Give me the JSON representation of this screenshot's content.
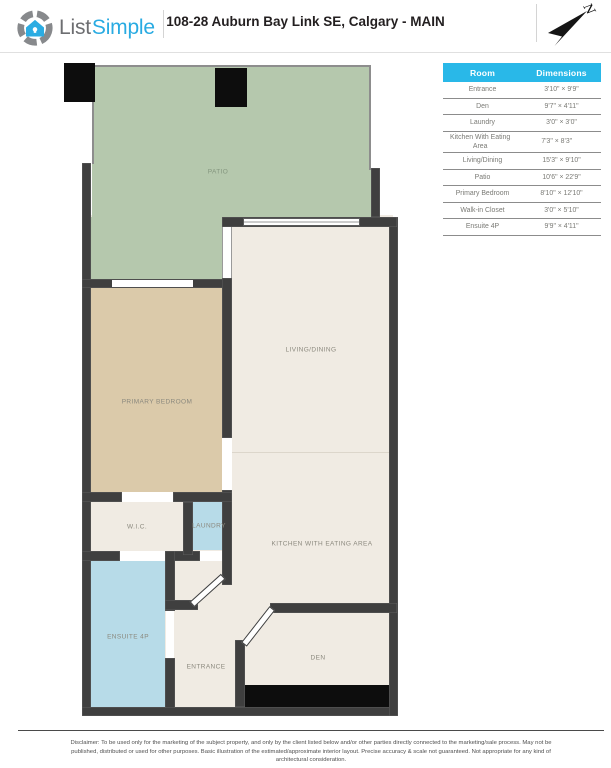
{
  "header": {
    "logo": {
      "list": "List",
      "simple": "Simple"
    },
    "title": "108-28 Auburn Bay Link SE, Calgary - MAIN",
    "compass_letter": "N"
  },
  "table": {
    "headers": [
      "Room",
      "Dimensions"
    ],
    "rows": [
      {
        "room": "Entrance",
        "dims": "3'10\" × 9'9\""
      },
      {
        "room": "Den",
        "dims": "9'7\" × 4'11\""
      },
      {
        "room": "Laundry",
        "dims": "3'0\" × 3'0\""
      },
      {
        "room": "Kitchen With Eating Area",
        "dims": "7'3\" × 8'3\""
      },
      {
        "room": "Living/Dining",
        "dims": "15'3\" × 9'10\""
      },
      {
        "room": "Patio",
        "dims": "10'6\" × 22'9\""
      },
      {
        "room": "Primary Bedroom",
        "dims": "8'10\" × 12'10\""
      },
      {
        "room": "Walk-in Closet",
        "dims": "3'0\" × 5'10\""
      },
      {
        "room": "Ensuite 4P",
        "dims": "9'9\" × 4'11\""
      }
    ]
  },
  "plan": {
    "rooms": {
      "patio": "PATIO",
      "living": "LIVING/DINING",
      "bedroom": "PRIMARY BEDROOM",
      "wic": "W.I.C.",
      "laundry": "LAUNDRY",
      "kitchen": "KITCHEN WITH EATING AREA",
      "ensuite": "ENSUITE 4P",
      "entrance": "ENTRANCE",
      "den": "DEN"
    }
  },
  "footer": {
    "disclaimer": [
      "Disclaimer: To be used only for the marketing of the subject property, and only by the client listed below and/or other parties directly connected to the marketing/sale process. May not be",
      "published, distributed or used for other purposes. Basic illustration of the estimated/approximate interior layout. Precise accuracy & scale not guaranteed. Not appropriate for any kind of",
      "architectural consideration."
    ]
  },
  "colors": {
    "accent_blue": "#29b8e8",
    "logo_blue": "#29abe2",
    "wall": "#3f3f3f",
    "patio_green": "#b5c8ad",
    "bedroom_tan": "#dbcaaa",
    "room_cream": "#f0ebe3",
    "wet_room_blue": "#b7dbe8"
  }
}
